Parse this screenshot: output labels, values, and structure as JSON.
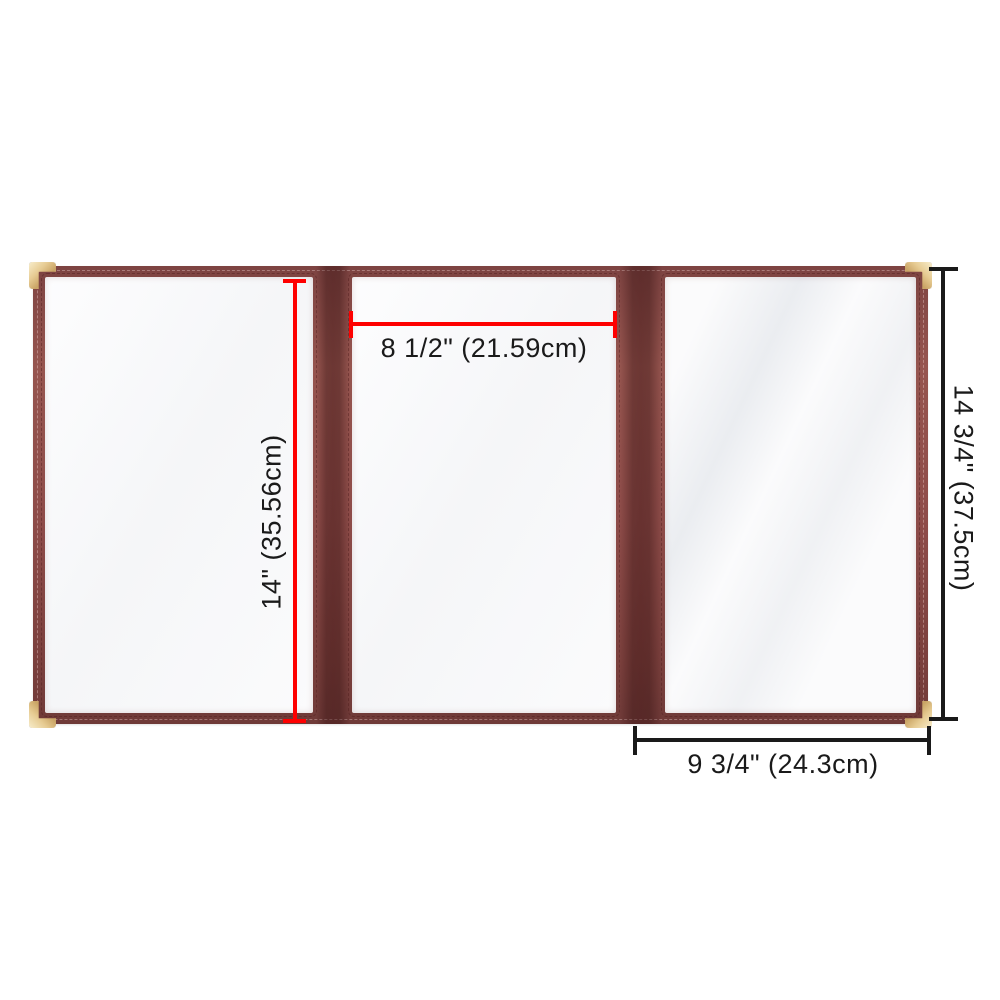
{
  "page": {
    "type": "product dimension photo",
    "background_color": "#ffffff"
  },
  "product": {
    "name": "trifold-menu-cover",
    "trim_color": "#8e4c49",
    "spine_color": "#6f3a38",
    "panel_color": "#fbfbfc",
    "corner_protector_color": "#e6cb92",
    "panels": [
      "left",
      "middle",
      "right"
    ]
  },
  "annotations": {
    "accent_red": "#fe0000",
    "accent_black": "#1a1a1a",
    "panel_width": {
      "label": "8 1/2\" (21.59cm)",
      "orientation": "horizontal",
      "color": "#fe0000"
    },
    "panel_height": {
      "label": "14\" (35.56cm)",
      "orientation": "vertical",
      "color": "#fe0000"
    },
    "overall_height": {
      "label": "14 3/4\" (37.5cm)",
      "orientation": "vertical",
      "color": "#1a1a1a"
    },
    "right_width": {
      "label": "9 3/4\" (24.3cm)",
      "orientation": "horizontal",
      "color": "#1a1a1a"
    }
  }
}
